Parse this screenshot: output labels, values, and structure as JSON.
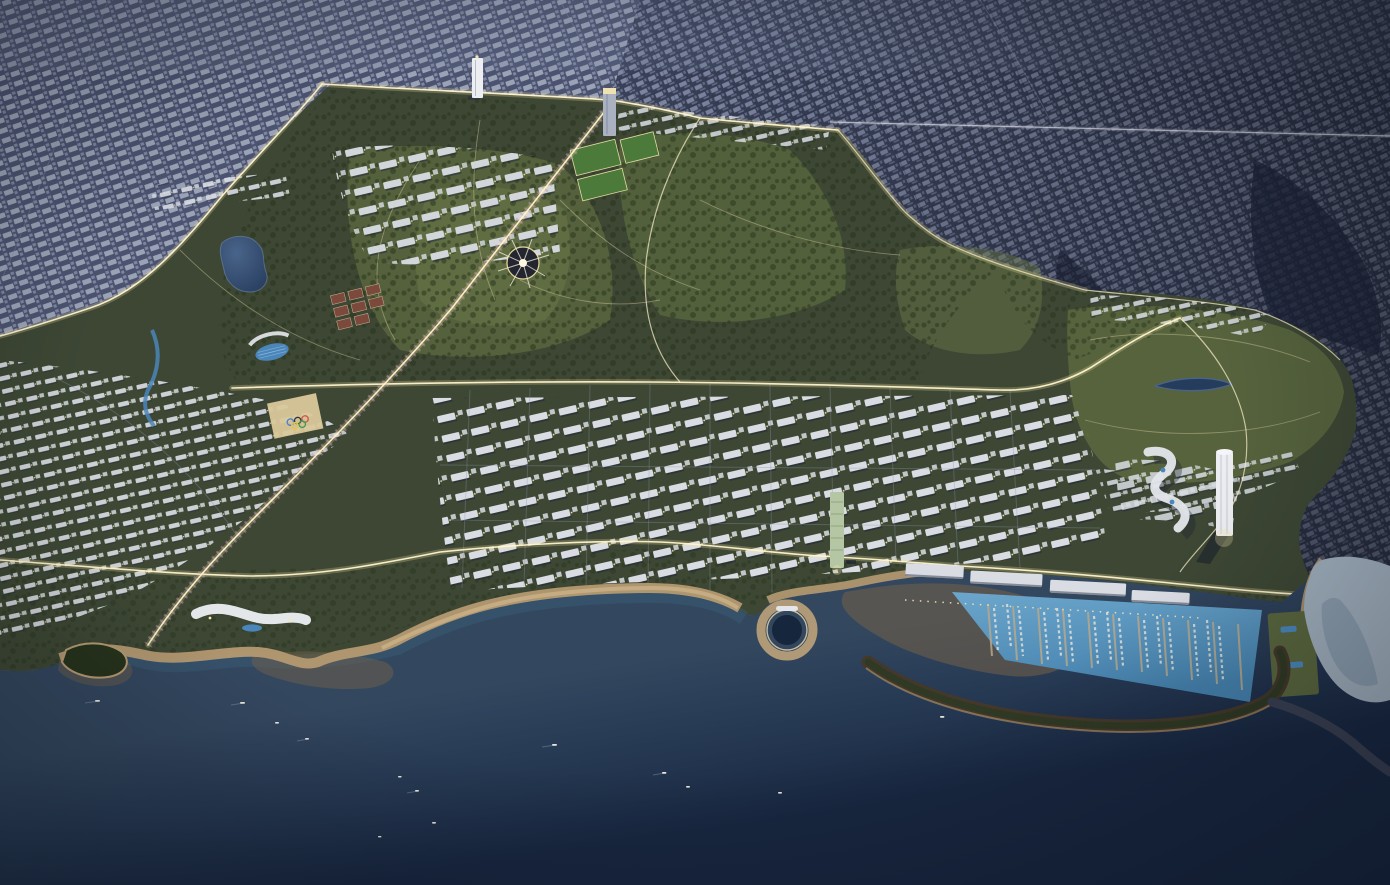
{
  "image": {
    "width": 1390,
    "height": 885,
    "description": "Nighttime aerial rendering of a coastal city masterplan: a large landscaped park and new low-rise districts with illuminated boulevards sit between a dense existing city (top) and the sea (bottom), with beaches, a circular sea-pool cove, a breakwater-protected marina full of yachts, and several landmark towers.",
    "time_of_day": "dusk/night",
    "view": "high oblique aerial"
  },
  "elements": [
    "existing-city-grid",
    "dense-city-blocks",
    "city-highway",
    "masterplan-park",
    "tree-canopy",
    "lawns",
    "kidney-lake",
    "lens-pond",
    "canal",
    "lit-canopy-pavilion",
    "sports-fields",
    "tennis-courts",
    "olympic-rings-plaza",
    "cherry-blossom-boulevard",
    "central-avenue",
    "coastal-avenue",
    "grid-district",
    "villa-district",
    "upper-district",
    "white-ribbon-resort",
    "sinuous-ribbon-building",
    "riviera-tower",
    "green-facade-tower",
    "north-towers",
    "beach",
    "circular-cove-pool",
    "shallow-sandbar",
    "marina-basin",
    "marina-docks",
    "moored-yachts",
    "quay-buildings",
    "curved-breakwater",
    "small-bay",
    "rocky-shore",
    "open-sea",
    "sailboats",
    "promontory"
  ],
  "palette": {
    "city-base-a": "#4b5370",
    "city-block-a1": "#9aa2b6",
    "city-block-a2": "#7e86a0",
    "city-base-b": "#394057",
    "city-block-b1": "#7f88a3",
    "city-block-b2": "#646d8a",
    "street-line": "#232a42",
    "site-green": "#3d4734",
    "lawn-light": "#59663e",
    "lawn-lighter": "#6b7847",
    "tree-dark": "#26331c",
    "sea-near": "#33475f",
    "sea-mid": "#273a54",
    "sea-deep": "#182741",
    "shallow-sand": "#7b6446",
    "beach-sand": "#b59a72",
    "beach-light": "#ccb187",
    "marina-water": "#4480ac",
    "marina-light": "#6ca6cc",
    "bay-water": "#a0afbd",
    "bay-shade": "#8296a8",
    "breakwater": "#43382a",
    "breakwater-trees": "#2b3a22",
    "rock-dark": "#394052",
    "road-lit-glow": "#f0dfa0",
    "road-lit-core": "#fff4cf",
    "road-dim": "#8d93a8",
    "blossom-pink": "#c08cb4",
    "path-light": "#d8cf9f",
    "building-white": "#d9dde3",
    "building-shadow": "#20273a",
    "light-warm": "#f6e7ae",
    "lake-blue": "#49648a",
    "lake-deep": "#263c5c",
    "pool-blue": "#4a86ba",
    "court-red": "#7c4a3c",
    "field-green": "#4c7a3a",
    "tower-white": "#eceef2",
    "tower-green": "#b5c6a4",
    "dock-tan": "#b7a88b",
    "boat-white": "#e9e6db",
    "olympic-blue": "#4a7fd0",
    "olympic-yellow": "#e8c84a",
    "olympic-black": "#30343a",
    "olympic-green": "#3f9950",
    "olympic-red": "#d05548"
  }
}
